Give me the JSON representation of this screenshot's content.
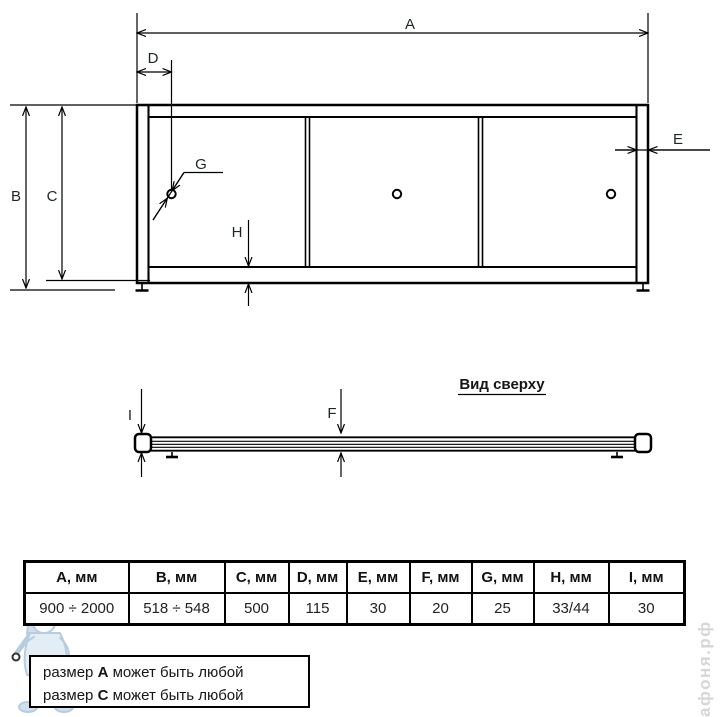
{
  "drawing": {
    "front_view": {
      "labels": {
        "A": "A",
        "B": "B",
        "C": "C",
        "D": "D",
        "E": "E",
        "G": "G",
        "H": "H"
      }
    },
    "top_view": {
      "title": "Вид сверху",
      "labels": {
        "I": "I",
        "F": "F"
      }
    }
  },
  "table": {
    "headers": [
      "A, мм",
      "B, мм",
      "C, мм",
      "D, мм",
      "E, мм",
      "F, мм",
      "G, мм",
      "H, мм",
      "I, мм"
    ],
    "values": [
      "900 ÷ 2000",
      "518 ÷ 548",
      "500",
      "115",
      "30",
      "20",
      "25",
      "33/44",
      "30"
    ]
  },
  "notes": {
    "lines": [
      {
        "prefix": "размер ",
        "bold": "A",
        "suffix": " может быть любой"
      },
      {
        "prefix": "размер ",
        "bold": "C",
        "suffix": " может быть любой"
      }
    ]
  },
  "watermark": {
    "site_label": "афоня.рф",
    "mascot": "plumber-mascot-watermark"
  },
  "colors": {
    "line": "#000000",
    "label_text": "#1c2626",
    "watermark_blue": "#a6c0d8",
    "watermark_gray": "#d6d6d6"
  }
}
